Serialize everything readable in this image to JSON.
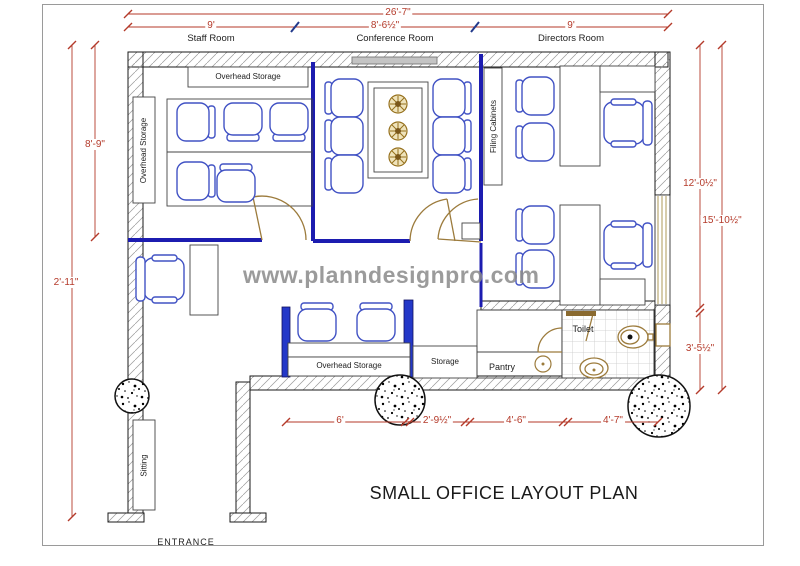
{
  "title": "SMALL OFFICE LAYOUT PLAN",
  "watermark": "www.planndesignpro.com",
  "entrance": "ENTRANCE",
  "room_labels": {
    "staff": "Staff Room",
    "conference": "Conference Room",
    "directors": "Directors Room"
  },
  "area_labels": {
    "overhead_storage_top": "Overhead Storage",
    "overhead_storage_left": "Overhead Storage",
    "overhead_storage_bottom": "Overhead Storage",
    "filing_cabinets": "Filing Cabinets",
    "storage": "Storage",
    "pantry": "Pantry",
    "toilet": "Toilet",
    "sitting": "Sitting"
  },
  "dimensions": {
    "top_total": "26'-7\"",
    "top_staff": "9'",
    "top_conference": "8'-6½\"",
    "top_directors": "9'",
    "left_staff_depth": "8'-9\"",
    "left_total": "2'-11\"",
    "right_upper": "12'-0½\"",
    "right_total": "15'-10½\"",
    "right_lower": "3'-5½\"",
    "bottom_1": "6'",
    "bottom_2": "2'-9½\"",
    "bottom_3": "4'-6\"",
    "bottom_4": "4'-7\""
  },
  "colors": {
    "dimension_red": "#b43a2a",
    "furniture_blue": "#4152c4",
    "wall_blue": "#1c1cb0",
    "door_tan": "#9c7b3c",
    "watermark_gray": "#8a8a8a"
  }
}
